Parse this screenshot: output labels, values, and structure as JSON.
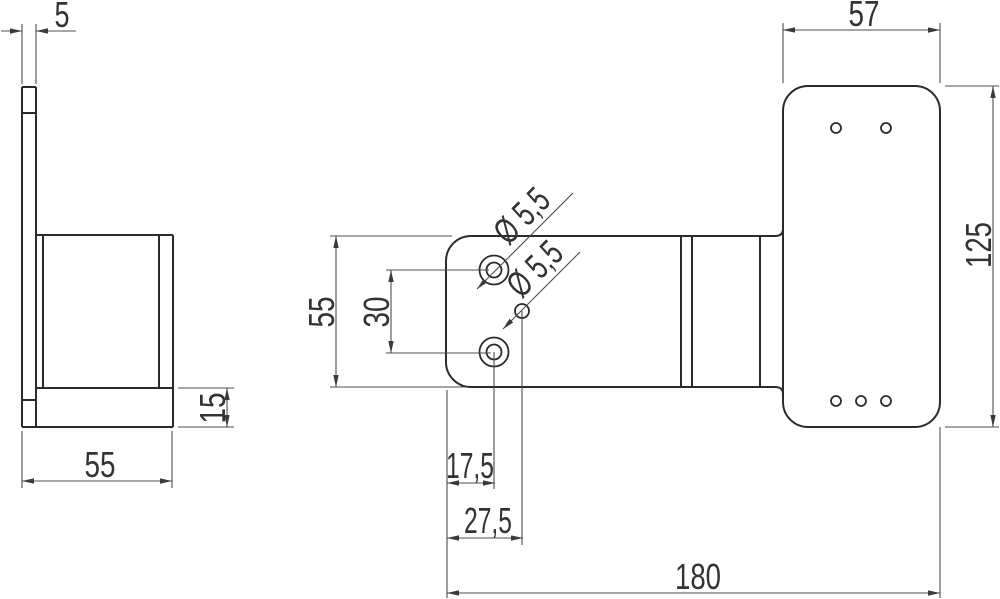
{
  "colors": {
    "background": "#ffffff",
    "outline": "#2b2b2b",
    "dim_lines": "#4d4d4d",
    "text": "#333333"
  },
  "side_view": {
    "thickness": "5",
    "width": "55",
    "base_height": "15"
  },
  "front_view": {
    "plate_height": "55",
    "hole_spacing": "30",
    "hole1_diameter": "Ø 5,5",
    "hole2_diameter": "Ø 5,5",
    "hole1_offset": "17,5",
    "hole2_offset": "27,5",
    "overall_length": "180"
  },
  "end_view": {
    "width": "57",
    "height": "125"
  }
}
